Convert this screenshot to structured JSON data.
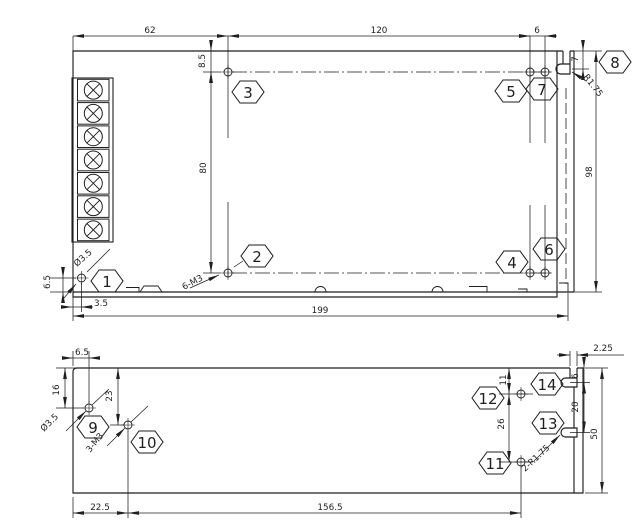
{
  "page": {
    "background": "#ffffff",
    "ink": "#1f1f1f"
  },
  "drawing": {
    "kind": "mechanical-dimension-drawing",
    "description": "Enclosure outline drawing, two views: chassis top view with 7-position screw terminal block and side mounting flange, and bottom view with mounting holes and keyhole slots",
    "views": [
      {
        "id": "top-view"
      },
      {
        "id": "bottom-view"
      }
    ],
    "terminal_block": {
      "count": 7
    },
    "dimension_labels": [
      {
        "text": "62",
        "x": 150,
        "y": 33
      },
      {
        "text": "120",
        "x": 379,
        "y": 33
      },
      {
        "text": "6",
        "x": 537,
        "y": 33
      },
      {
        "text": "8.5",
        "x": 205,
        "y": 61,
        "rot": -90
      },
      {
        "text": "80",
        "x": 206,
        "y": 168,
        "rot": -90
      },
      {
        "text": "98",
        "x": 592,
        "y": 172,
        "rot": -90
      },
      {
        "text": "7",
        "x": 578,
        "y": 59,
        "rot": -90
      },
      {
        "text": "R1.75",
        "x": 583,
        "y": 77,
        "rot": 52,
        "anchor": "start"
      },
      {
        "text": "Ø3.5",
        "x": 77,
        "y": 267,
        "rot": -42,
        "anchor": "start"
      },
      {
        "text": "6.5",
        "x": 50,
        "y": 282,
        "rot": -90
      },
      {
        "text": "3.5",
        "x": 101,
        "y": 306
      },
      {
        "text": "6-M3",
        "x": 184,
        "y": 290,
        "rot": -28,
        "anchor": "start"
      },
      {
        "text": "199",
        "x": 320,
        "y": 313
      },
      {
        "text": "6.5",
        "x": 82,
        "y": 355
      },
      {
        "text": "16",
        "x": 59,
        "y": 390,
        "rot": -90
      },
      {
        "text": "23",
        "x": 112,
        "y": 396,
        "rot": -90
      },
      {
        "text": "Ø3.5",
        "x": 44,
        "y": 432,
        "rot": -45,
        "anchor": "start"
      },
      {
        "text": "3-M3",
        "x": 90,
        "y": 453,
        "rot": -51,
        "anchor": "start"
      },
      {
        "text": "22.5",
        "x": 100,
        "y": 510
      },
      {
        "text": "156.5",
        "x": 330,
        "y": 510
      },
      {
        "text": "11",
        "x": 506,
        "y": 380,
        "rot": -90
      },
      {
        "text": "26",
        "x": 504,
        "y": 424,
        "rot": -90
      },
      {
        "text": "2-R1.75",
        "x": 525,
        "y": 472,
        "rot": -43,
        "anchor": "start"
      },
      {
        "text": "20",
        "x": 578,
        "y": 407,
        "rot": -90
      },
      {
        "text": "6",
        "x": 578,
        "y": 376,
        "rot": -90
      },
      {
        "text": "50",
        "x": 597,
        "y": 434,
        "rot": -90
      },
      {
        "text": "2.25",
        "x": 603,
        "y": 351
      }
    ],
    "callouts": [
      {
        "num": "1",
        "x": 107,
        "y": 281
      },
      {
        "num": "2",
        "x": 257,
        "y": 256
      },
      {
        "num": "3",
        "x": 248,
        "y": 92
      },
      {
        "num": "4",
        "x": 512,
        "y": 262
      },
      {
        "num": "5",
        "x": 511,
        "y": 91
      },
      {
        "num": "6",
        "x": 549,
        "y": 249
      },
      {
        "num": "7",
        "x": 542,
        "y": 89
      },
      {
        "num": "8",
        "x": 615,
        "y": 62
      },
      {
        "num": "9",
        "x": 93,
        "y": 427
      },
      {
        "num": "10",
        "x": 147,
        "y": 442
      },
      {
        "num": "11",
        "x": 495,
        "y": 463
      },
      {
        "num": "12",
        "x": 488,
        "y": 398
      },
      {
        "num": "13",
        "x": 548,
        "y": 423
      },
      {
        "num": "14",
        "x": 547,
        "y": 384
      }
    ],
    "holes": [
      {
        "x": 228,
        "y": 72
      },
      {
        "x": 530,
        "y": 72
      },
      {
        "x": 545,
        "y": 72
      },
      {
        "x": 228,
        "y": 273
      },
      {
        "x": 530,
        "y": 273
      },
      {
        "x": 545,
        "y": 273
      },
      {
        "x": 81.5,
        "y": 278
      },
      {
        "x": 89,
        "y": 408
      },
      {
        "x": 128,
        "y": 425
      },
      {
        "x": 521,
        "y": 394
      },
      {
        "x": 521,
        "y": 462
      }
    ]
  }
}
